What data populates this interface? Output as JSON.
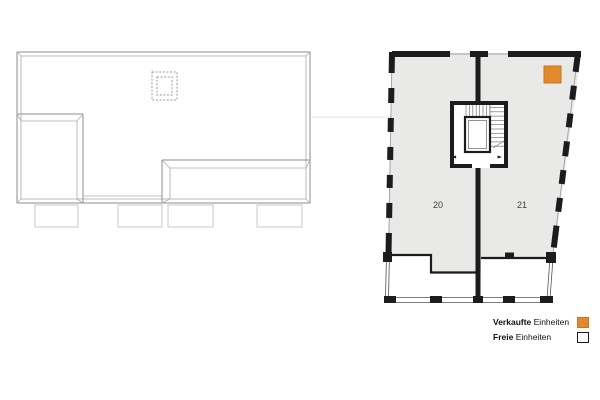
{
  "colors": {
    "sold_orange": "#E2892B",
    "sold_orange_border": "#C9751D",
    "floor_fill": "#E9E9E8",
    "wall_black": "#1C1C1C",
    "roof_line": "#8E8E8E",
    "terrace_line": "#C9C9C9",
    "faint_guide": "#E3E3E3"
  },
  "floor_plan": {
    "units": [
      {
        "number": "20",
        "status": "free"
      },
      {
        "number": "21",
        "status": "sold"
      }
    ],
    "sold_marker_in_unit": "21",
    "icons": {
      "entry_arrow_left": "◄",
      "entry_arrow_right": "►"
    }
  },
  "legend": {
    "items": [
      {
        "word_bold": "Verkaufte",
        "word_rest": " Einheiten",
        "swatch": "sold"
      },
      {
        "word_bold": "Freie",
        "word_rest": " Einheiten",
        "swatch": "free"
      }
    ]
  }
}
